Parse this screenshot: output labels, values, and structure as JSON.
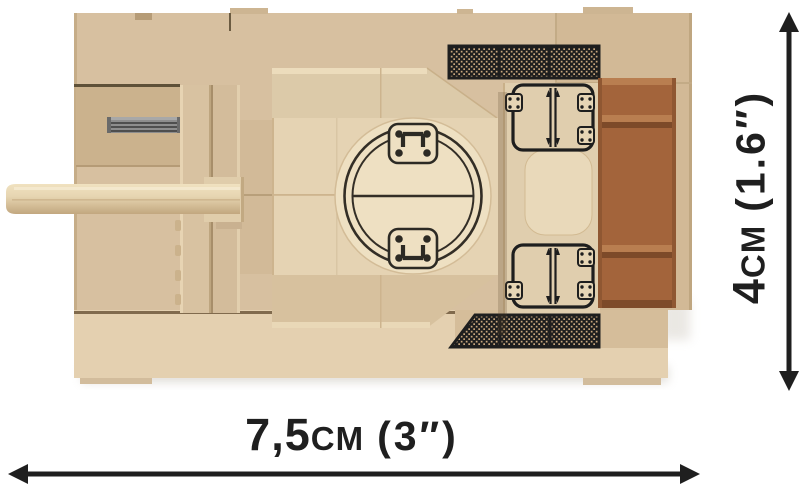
{
  "figure": {
    "subject": "Top-down view of a tan brick-built toy tank model with printed circular turret hatch, engine grilles, rear hatch prints, a brown stowage block and a forward gun barrel"
  },
  "dimensions": {
    "width": {
      "value": "7,5",
      "unit": "CM",
      "imperial": "(3″)"
    },
    "height": {
      "value": "4",
      "unit": "CM",
      "imperial": "(1.6″)"
    }
  },
  "colors": {
    "background": "#ffffff",
    "hull_tan": "#d7c0a0",
    "hull_rear": "#d2b996",
    "hull_light": "#e4d0b0",
    "panel_recess": "#cbb28d",
    "turret_top": "#e5d3b3",
    "turret_bevel": "#dccaa9",
    "turret_side": "#d2ba98",
    "disc_cream": "#eee0c2",
    "brown": "#a3643b",
    "brown_light": "#b97e50",
    "brown_dark": "#7d4a29",
    "rod_gray": "#8d8d8d",
    "print_black": "#1e1e1e",
    "dim_black": "#1f1f1f"
  }
}
